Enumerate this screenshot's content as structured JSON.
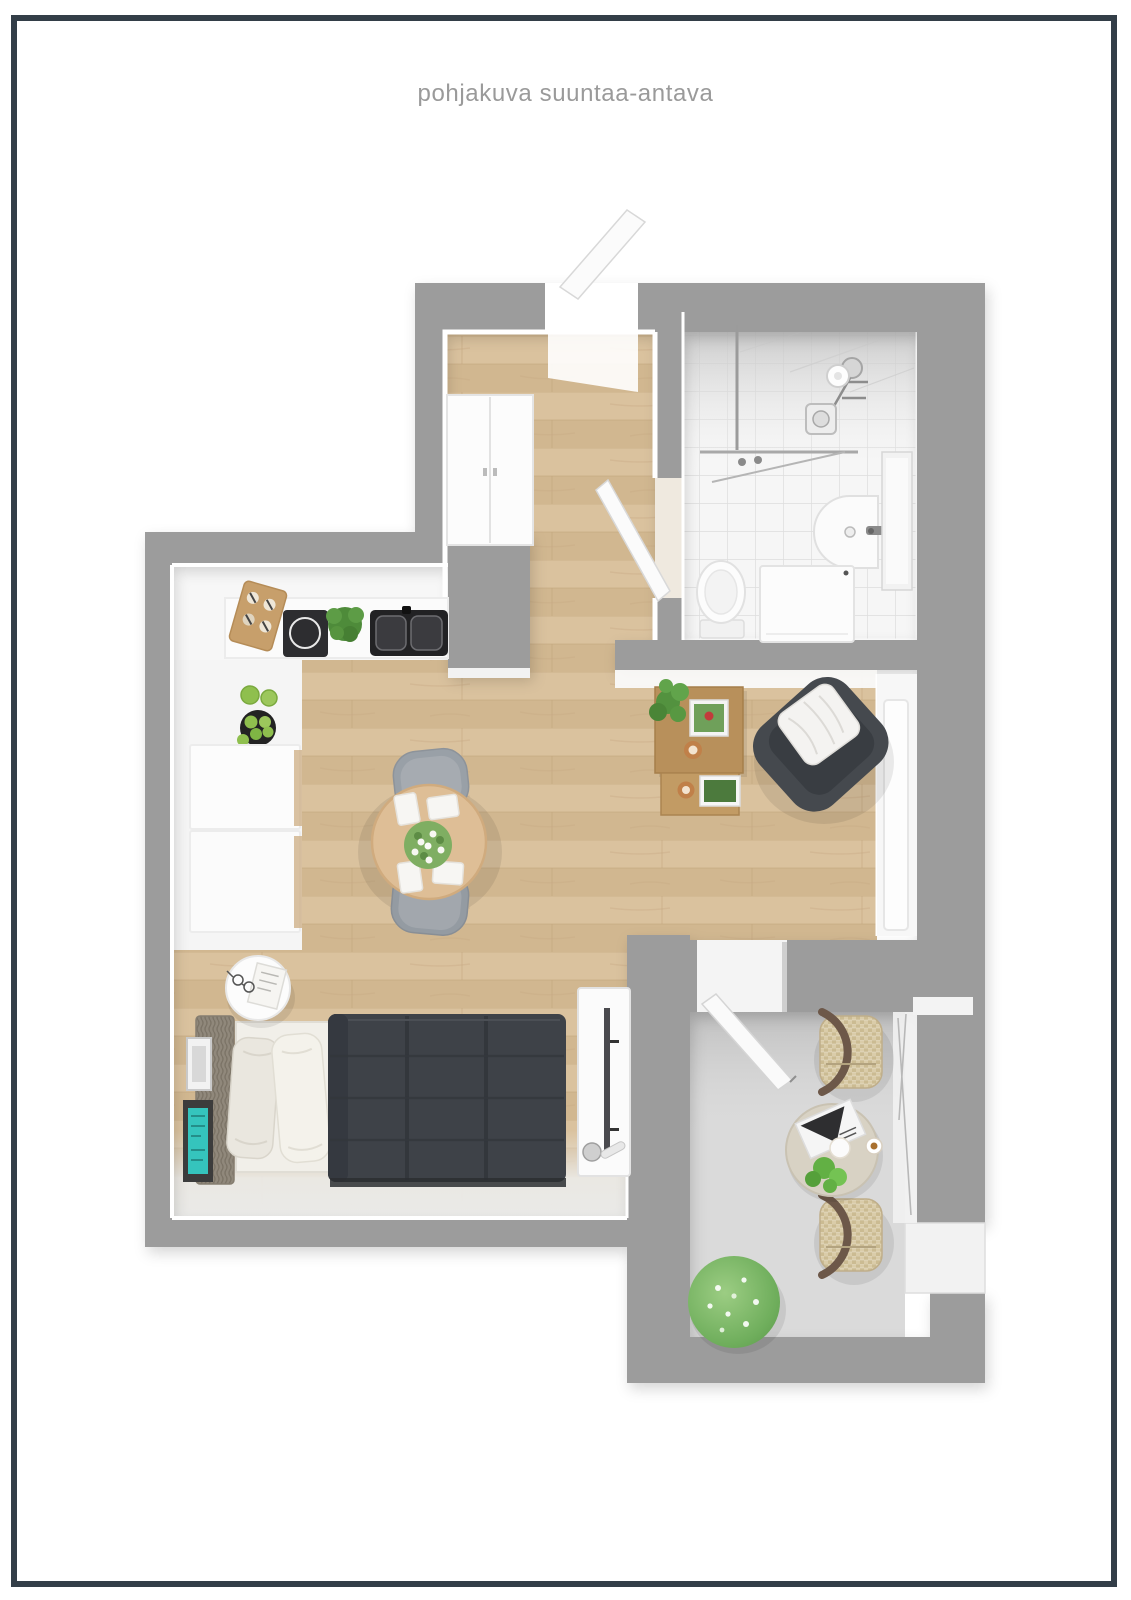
{
  "page": {
    "title": "pohjakuva suuntaa-antava"
  },
  "colors": {
    "frame": "#333e48",
    "title": "#9a9a9a",
    "wall": "#9c9c9c",
    "wood": "#d6bd98",
    "tile": "#f6f6f6",
    "balcony_floor": "#dadada",
    "duvet": "#3e4248",
    "armchair": "#45494e",
    "coffee_table_wood": "#b8905b",
    "dining_table_wood": "#debe96",
    "accent_teal": "#35c4bd",
    "plant_green": "#6fae5c"
  },
  "floorplan": {
    "rooms": [
      "entry-hall",
      "bathroom",
      "kitchen",
      "living-room",
      "sleeping-area",
      "balcony"
    ],
    "furniture": [
      "front-door",
      "hall-closet",
      "shower",
      "washbasin",
      "toilet",
      "washing-machine",
      "kitchen-counter",
      "cooktop",
      "kitchen-sink",
      "cutting-board",
      "fruit-bowl",
      "refrigerator-cabinets",
      "dining-table",
      "dining-chairs",
      "flower-bouquet",
      "coffee-table",
      "nesting-side-table",
      "armchair",
      "tv-stand",
      "window",
      "bed",
      "pillows",
      "duvet",
      "nightstand",
      "wall-art",
      "balcony-door",
      "balcony-chairs",
      "balcony-table",
      "balcony-bush",
      "balcony-railing"
    ]
  }
}
